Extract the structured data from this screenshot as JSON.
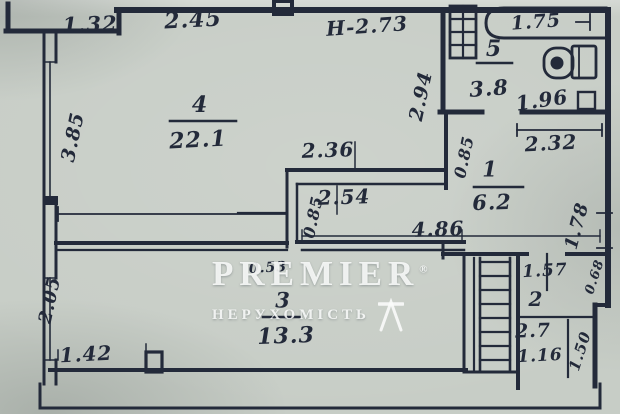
{
  "watermark": {
    "brand": "PREMIER",
    "registered": "®",
    "subtitle": "НЕРУХОМІСТЬ"
  },
  "colors": {
    "paper": "#c7cdc6",
    "ink": "#232a3a",
    "watermark": "#fafcfa"
  },
  "plan": {
    "type": "apartment-floor-plan",
    "height_note": "Н-2.73",
    "rooms": [
      {
        "number": "4",
        "area": "22.1"
      },
      {
        "number": "1",
        "area": "6.2"
      },
      {
        "number": "5",
        "area": "3.8"
      },
      {
        "number": "3",
        "area": "13.3"
      },
      {
        "number": "2",
        "area": "2.7"
      }
    ],
    "labels": [
      {
        "name": "dim-1-32",
        "text": "1.32",
        "x": 90,
        "y": 24,
        "fs": 21,
        "rot": -2
      },
      {
        "name": "dim-2-45",
        "text": "2.45",
        "x": 193,
        "y": 20,
        "fs": 22,
        "rot": -3
      },
      {
        "name": "height-note",
        "text": "Н-2.73",
        "x": 367,
        "y": 26,
        "fs": 20,
        "rot": -4
      },
      {
        "name": "dim-1-75",
        "text": "1.75",
        "x": 536,
        "y": 22,
        "fs": 19,
        "rot": -4
      },
      {
        "name": "room-5-number",
        "text": "5",
        "x": 494,
        "y": 49,
        "fs": 22,
        "rot": 0
      },
      {
        "name": "room-5-area",
        "text": "3.8",
        "x": 489,
        "y": 88,
        "fs": 21,
        "rot": -4
      },
      {
        "name": "dim-1-96",
        "text": "1.96",
        "x": 542,
        "y": 100,
        "fs": 20,
        "rot": -8
      },
      {
        "name": "dim-2-94",
        "text": "2.94",
        "x": 421,
        "y": 96,
        "fs": 19,
        "rot": -78
      },
      {
        "name": "dim-3-85",
        "text": "3.85",
        "x": 73,
        "y": 137,
        "fs": 19,
        "rot": -78
      },
      {
        "name": "room-4-number",
        "text": "4",
        "x": 200,
        "y": 105,
        "fs": 22,
        "rot": 0
      },
      {
        "name": "room-4-area",
        "text": "22.1",
        "x": 198,
        "y": 140,
        "fs": 22,
        "rot": -3
      },
      {
        "name": "dim-2-36",
        "text": "2.36",
        "x": 328,
        "y": 150,
        "fs": 20,
        "rot": -2
      },
      {
        "name": "dim-2-54",
        "text": "2.54",
        "x": 344,
        "y": 197,
        "fs": 20,
        "rot": -2
      },
      {
        "name": "dim-0-85-corridor",
        "text": "0.85",
        "x": 313,
        "y": 217,
        "fs": 16,
        "rot": -78
      },
      {
        "name": "dim-4-86",
        "text": "4.86",
        "x": 438,
        "y": 229,
        "fs": 20,
        "rot": -2
      },
      {
        "name": "dim-0-85-hall",
        "text": "0.85",
        "x": 464,
        "y": 157,
        "fs": 16,
        "rot": -78
      },
      {
        "name": "room-1-number",
        "text": "1",
        "x": 490,
        "y": 169,
        "fs": 21,
        "rot": 0
      },
      {
        "name": "room-1-area",
        "text": "6.2",
        "x": 492,
        "y": 202,
        "fs": 21,
        "rot": -2
      },
      {
        "name": "dim-2-32",
        "text": "2.32",
        "x": 551,
        "y": 143,
        "fs": 20,
        "rot": -3
      },
      {
        "name": "dim-1-78",
        "text": "1.78",
        "x": 577,
        "y": 226,
        "fs": 18,
        "rot": -75
      },
      {
        "name": "dim-0-53",
        "text": "0.53",
        "x": 268,
        "y": 268,
        "fs": 14,
        "rot": -3
      },
      {
        "name": "room-3-number",
        "text": "3",
        "x": 283,
        "y": 300,
        "fs": 21,
        "rot": 0
      },
      {
        "name": "room-3-area",
        "text": "13.3",
        "x": 286,
        "y": 336,
        "fs": 22,
        "rot": -2
      },
      {
        "name": "dim-2-05",
        "text": "2.05",
        "x": 50,
        "y": 300,
        "fs": 18,
        "rot": -78
      },
      {
        "name": "dim-1-42",
        "text": "1.42",
        "x": 86,
        "y": 354,
        "fs": 20,
        "rot": -3
      },
      {
        "name": "dim-1-57",
        "text": "1.57",
        "x": 545,
        "y": 271,
        "fs": 17,
        "rot": -3
      },
      {
        "name": "dim-0-68",
        "text": "0.68",
        "x": 595,
        "y": 277,
        "fs": 13,
        "rot": -72
      },
      {
        "name": "room-2-number",
        "text": "2",
        "x": 536,
        "y": 299,
        "fs": 20,
        "rot": 0
      },
      {
        "name": "room-2-area",
        "text": "2.7",
        "x": 533,
        "y": 331,
        "fs": 19,
        "rot": -2
      },
      {
        "name": "dim-1-16",
        "text": "1.16",
        "x": 540,
        "y": 356,
        "fs": 17,
        "rot": -3
      },
      {
        "name": "dim-1-50",
        "text": "1.50",
        "x": 580,
        "y": 351,
        "fs": 15,
        "rot": -72
      }
    ]
  }
}
